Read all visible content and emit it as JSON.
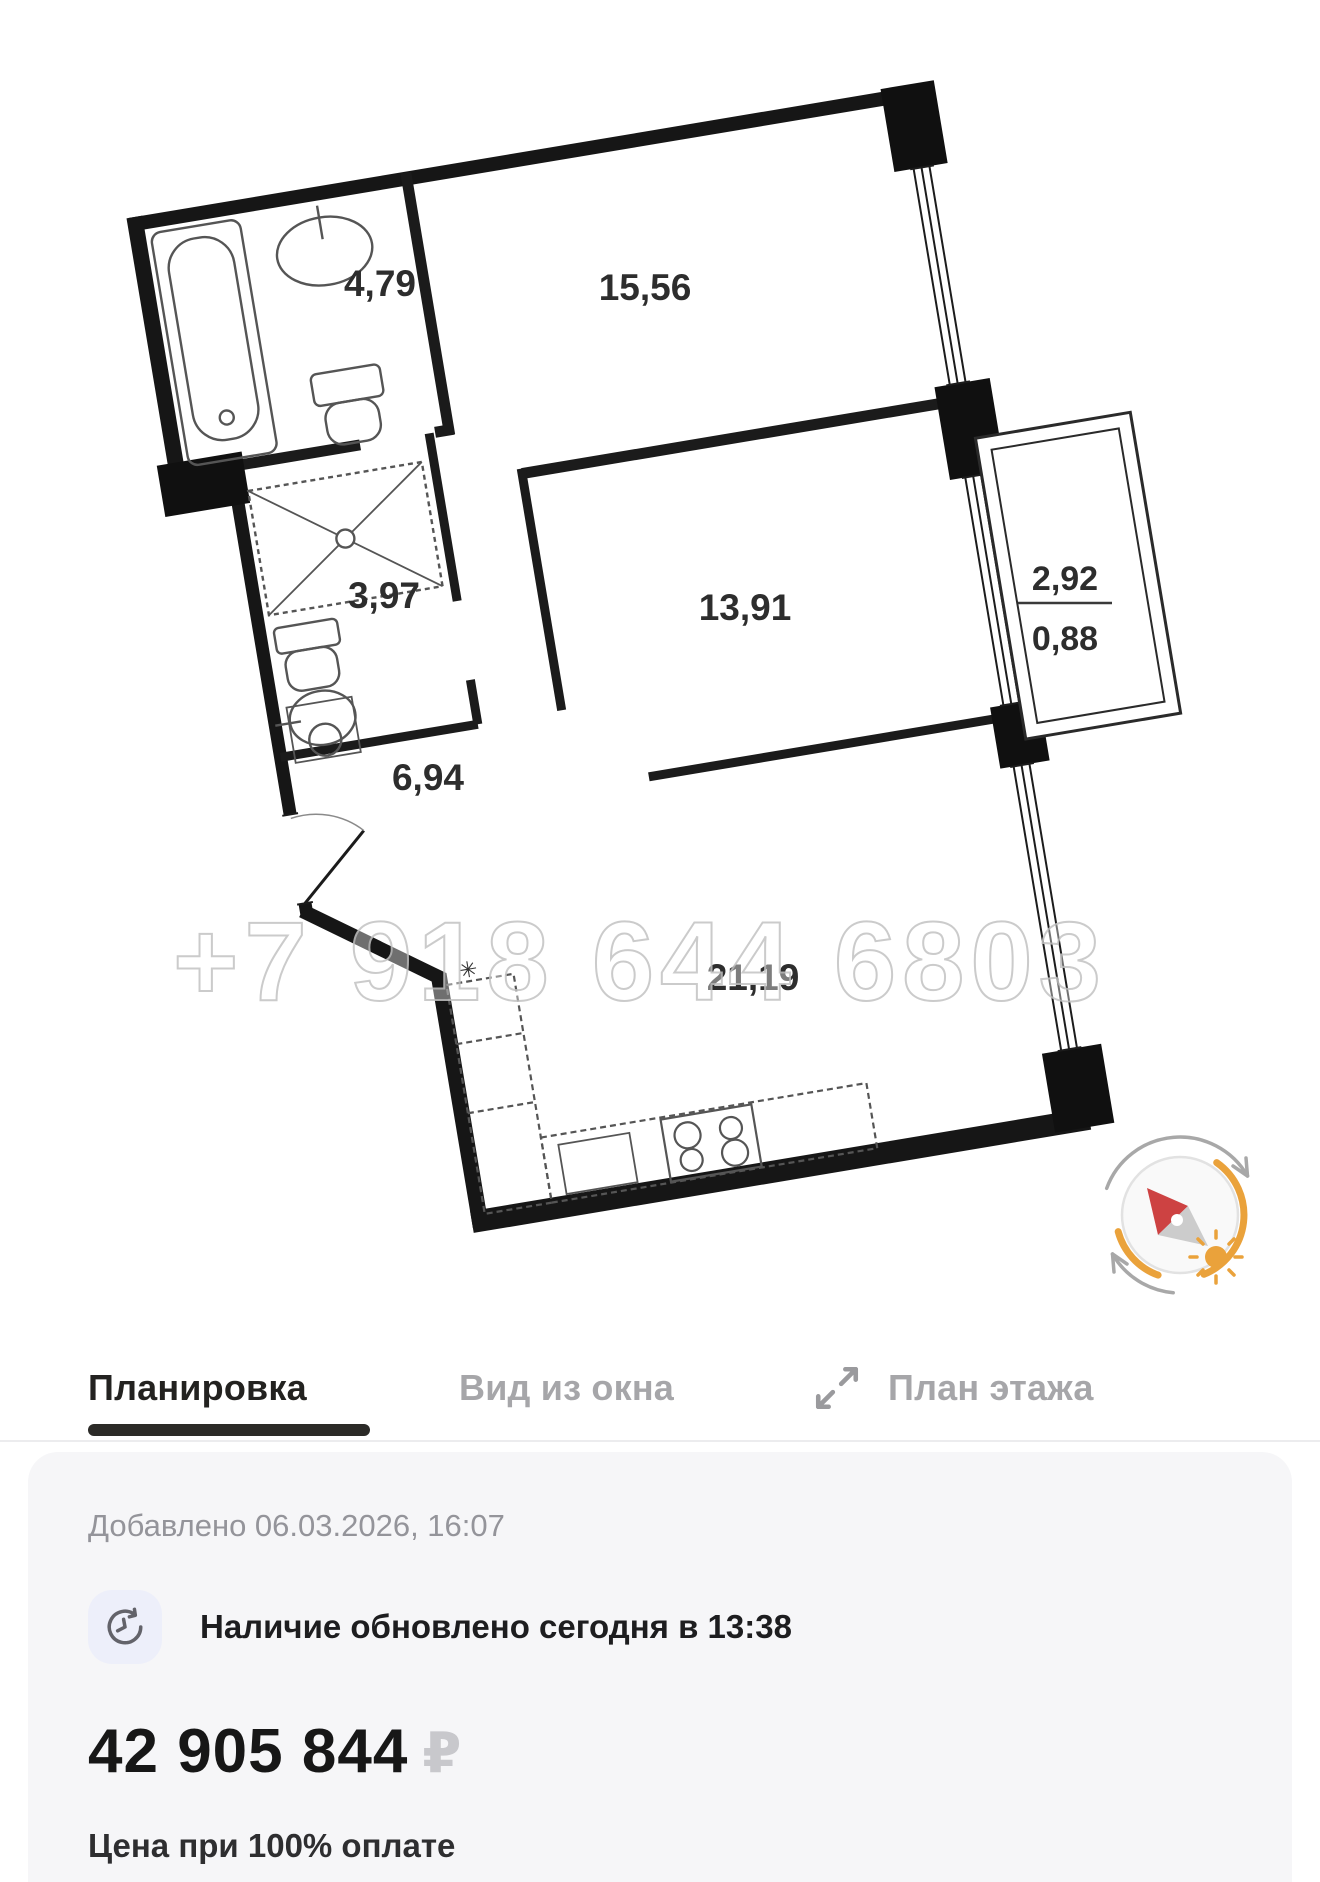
{
  "floor_plan": {
    "rooms": [
      {
        "id": "bathroom",
        "area": "4,79"
      },
      {
        "id": "bedroom-1",
        "area": "15,56"
      },
      {
        "id": "wc",
        "area": "3,97"
      },
      {
        "id": "bedroom-2",
        "area": "13,91"
      },
      {
        "id": "hallway",
        "area": "6,94"
      },
      {
        "id": "kitchen-living",
        "area": "21,19"
      }
    ],
    "balcony": {
      "area_full": "2,92",
      "area_reduced": "0,88"
    },
    "vent_symbol": "✳",
    "watermark": "+7 918 644 6803"
  },
  "tabs": {
    "items": [
      {
        "label": "Планировка",
        "active": true
      },
      {
        "label": "Вид из окна",
        "active": false
      },
      {
        "label": "План этажа",
        "active": false
      }
    ]
  },
  "listing": {
    "added": "Добавлено 06.03.2026, 16:07",
    "availability": "Наличие обновлено сегодня в 13:38",
    "price": "42 905 844",
    "currency": "₽",
    "price_note": "Цена при 100% оплате"
  },
  "colors": {
    "accent_orange": "#EAA23B",
    "needle_red": "#CD4242",
    "card_bg": "#F6F6F8",
    "tab_active": "#232220",
    "tab_inactive": "#A6A6A9",
    "watermark_stroke": "#C3C3C3"
  }
}
